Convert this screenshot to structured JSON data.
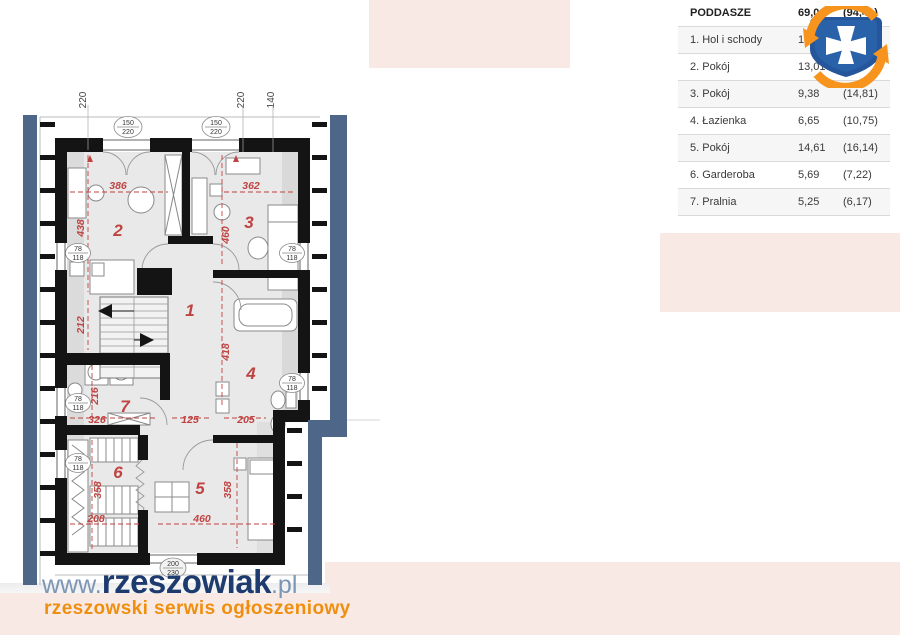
{
  "colors": {
    "pink": "#f8e9e4",
    "blue_band": "#4e6687",
    "dim_red": "#bf4341",
    "navy": "#1d3b6e",
    "light_blue": "#7d95b5",
    "orange": "#ef8f10"
  },
  "table": {
    "header": {
      "label": "PODDASZE",
      "area": "69,01",
      "gross": "(94,41)"
    },
    "rows": [
      {
        "label": "1. Hol i schody",
        "area": "14,42",
        "gross": ""
      },
      {
        "label": "2. Pokój",
        "area": "13,01",
        "gross": ")"
      },
      {
        "label": "3. Pokój",
        "area": "9,38",
        "gross": "(14,81)"
      },
      {
        "label": "4. Łazienka",
        "area": "6,65",
        "gross": "(10,75)"
      },
      {
        "label": "5. Pokój",
        "area": "14,61",
        "gross": "(16,14)"
      },
      {
        "label": "6. Garderoba",
        "area": "5,69",
        "gross": "(7,22)"
      },
      {
        "label": "7. Pralnia",
        "area": "5,25",
        "gross": "(6,17)"
      }
    ]
  },
  "plan": {
    "top_dims": {
      "d1": "220",
      "d2": "220",
      "d3": "140"
    },
    "rooms": {
      "r1": "1",
      "r2": "2",
      "r3": "3",
      "r4": "4",
      "r5": "5",
      "r6": "6",
      "r7": "7"
    },
    "dims": {
      "room2_w": "386",
      "room3_w": "362",
      "room2_h": "438",
      "room3_h": "460",
      "stairs_h": "212",
      "hall_h": "418",
      "room7_h": "216",
      "room7_w": "326",
      "hall_w": "125",
      "bath_w": "205",
      "room6_h": "358",
      "room6_w": "208",
      "room5_w": "460",
      "room5_h": "358"
    },
    "labels": {
      "win_top_a": "150",
      "win_top_b": "220",
      "win_small_a": "78",
      "win_small_b": "118",
      "door_a": "200",
      "door_b": "230"
    }
  },
  "footer": {
    "www": "www.",
    "name": "rzeszowiak",
    "tld": ".pl",
    "tagline": "rzeszowski serwis ogłoszeniowy"
  }
}
